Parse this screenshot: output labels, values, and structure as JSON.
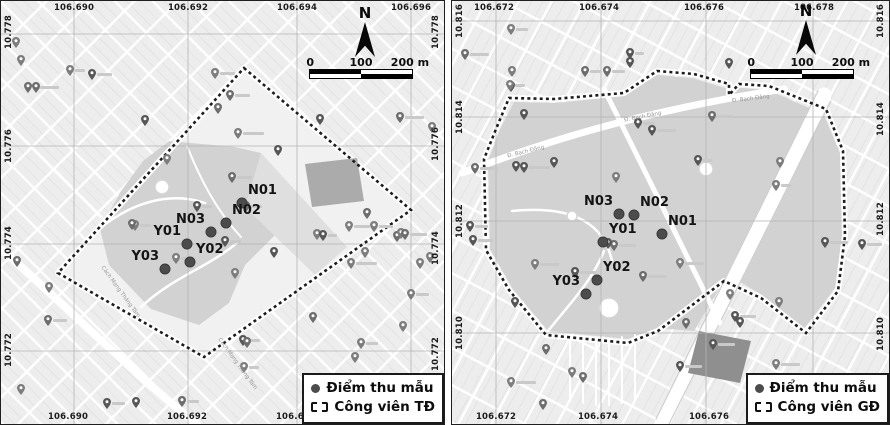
{
  "colors": {
    "map_bg": "#ededed",
    "street": "#ffffff",
    "grid_line": "#b3b3b3",
    "diamond_interior": "#f1f1f1",
    "park_fill": "#d2d2d2",
    "park_fill_light": "#dfdfdf",
    "boundary": "#1d1d1d",
    "point_dot": "#4c4c4c",
    "pin": "#6d6d6d",
    "text": "#141414"
  },
  "panels": [
    {
      "id": "tao-dan",
      "size": {
        "w": 443,
        "h": 423
      },
      "north_label": "N",
      "scale_ticks": [
        "0",
        "100",
        "200 m"
      ],
      "north_pos": {
        "left": 344,
        "top": 5
      },
      "scale_pos": {
        "left": 308,
        "top": 55
      },
      "coords": {
        "top": [
          {
            "t": "106.690",
            "x": 73
          },
          {
            "t": "106.692",
            "x": 187
          },
          {
            "t": "106.694",
            "x": 296
          },
          {
            "t": "106.696",
            "x": 410
          }
        ],
        "bottom": [
          {
            "t": "106.690",
            "x": 67
          },
          {
            "t": "106.692",
            "x": 186
          },
          {
            "t": "106.694",
            "x": 295
          }
        ],
        "left": [
          {
            "t": "10.778",
            "y": 31
          },
          {
            "t": "10.776",
            "y": 145
          },
          {
            "t": "10.774",
            "y": 242
          },
          {
            "t": "10.772",
            "y": 349
          }
        ],
        "right": [
          {
            "t": "10.778",
            "y": 31
          },
          {
            "t": "10.776",
            "y": 143
          },
          {
            "t": "10.774",
            "y": 247
          },
          {
            "t": "10.772",
            "y": 353
          }
        ]
      },
      "grid": {
        "v": [
          73,
          187,
          296,
          410
        ],
        "h": [
          33,
          145,
          243,
          350
        ]
      },
      "boundary": [
        [
          243,
          67
        ],
        [
          410,
          209
        ],
        [
          203,
          356
        ],
        [
          57,
          272
        ]
      ],
      "interior": [
        [
          243,
          67
        ],
        [
          410,
          209
        ],
        [
          203,
          356
        ],
        [
          57,
          272
        ]
      ],
      "park_fills": [
        {
          "c": "#d2d2d2",
          "pts": [
            [
              168,
              140
            ],
            [
              234,
              146
            ],
            [
              260,
              152
            ],
            [
              264,
              172
            ],
            [
              302,
              206
            ],
            [
              268,
              240
            ],
            [
              244,
              264
            ],
            [
              228,
              302
            ],
            [
              198,
              324
            ],
            [
              150,
              308
            ],
            [
              108,
              264
            ],
            [
              99,
              228
            ],
            [
              120,
              190
            ],
            [
              142,
              160
            ]
          ]
        },
        {
          "c": "#dfdfdf",
          "pts": [
            [
              260,
              152
            ],
            [
              346,
              246
            ],
            [
              314,
              274
            ],
            [
              244,
              206
            ]
          ]
        }
      ],
      "dark_blocks": [
        {
          "c": "#ababab",
          "pts": [
            [
              304,
              163
            ],
            [
              356,
              157
            ],
            [
              363,
              200
            ],
            [
              311,
              206
            ]
          ]
        }
      ],
      "roads": [
        {
          "d": "M0,248 C60,300 140,380 196,423",
          "w": 8
        },
        {
          "d": "M98,228 C130,202 168,190 204,202",
          "w": 2.5
        },
        {
          "d": "M140,306 C172,276 204,268 236,242",
          "w": 2.5
        },
        {
          "d": "M186,145 C200,180 216,210 240,236",
          "w": 2
        }
      ],
      "circles": [
        {
          "x": 161,
          "y": 186,
          "r": 7
        }
      ],
      "points": [
        {
          "label": "N01",
          "x": 241,
          "y": 202,
          "side": "right"
        },
        {
          "label": "N02",
          "x": 225,
          "y": 222,
          "side": "right"
        },
        {
          "label": "N03",
          "x": 210,
          "y": 231,
          "side": "left"
        },
        {
          "label": "Y01",
          "x": 186,
          "y": 243,
          "side": "left"
        },
        {
          "label": "Y02",
          "x": 189,
          "y": 261,
          "side": "right"
        },
        {
          "label": "Y03",
          "x": 164,
          "y": 268,
          "side": "left"
        }
      ],
      "street_labels": [
        {
          "t": "Cách Mạng Tháng Tám",
          "x": 88,
          "y": 288,
          "a": 54
        },
        {
          "t": "Cách Mạng Tháng Tám",
          "x": 205,
          "y": 360,
          "a": 54
        }
      ],
      "legend": {
        "points": "Điểm thu mẫu",
        "park": "Công viên TĐ"
      },
      "pin_seed": 7
    },
    {
      "id": "gia-dinh",
      "size": {
        "w": 437,
        "h": 423
      },
      "north_label": "N",
      "scale_ticks": [
        "0",
        "100",
        "200 m"
      ],
      "north_pos": {
        "left": 334,
        "top": 3
      },
      "scale_pos": {
        "left": 298,
        "top": 55
      },
      "coords": {
        "top": [
          {
            "t": "106.672",
            "x": 42
          },
          {
            "t": "106.674",
            "x": 147
          },
          {
            "t": "106.676",
            "x": 252
          },
          {
            "t": "106.678",
            "x": 362
          }
        ],
        "bottom": [
          {
            "t": "106.672",
            "x": 44
          },
          {
            "t": "106.674",
            "x": 146
          },
          {
            "t": "106.676",
            "x": 257
          }
        ],
        "left": [
          {
            "t": "10.816",
            "y": 20
          },
          {
            "t": "10.814",
            "y": 116
          },
          {
            "t": "10.812",
            "y": 220
          },
          {
            "t": "10.810",
            "y": 332
          }
        ],
        "right": [
          {
            "t": "10.816",
            "y": 20
          },
          {
            "t": "10.814",
            "y": 118
          },
          {
            "t": "10.812",
            "y": 218
          },
          {
            "t": "10.810",
            "y": 333
          }
        ]
      },
      "grid": {
        "v": [
          44,
          149,
          254,
          361
        ],
        "h": [
          20,
          116,
          220,
          332
        ]
      },
      "boundary": [
        [
          205,
          70
        ],
        [
          242,
          73
        ],
        [
          277,
          83
        ],
        [
          277,
          94
        ],
        [
          287,
          83
        ],
        [
          317,
          85
        ],
        [
          374,
          108
        ],
        [
          391,
          150
        ],
        [
          393,
          235
        ],
        [
          386,
          290
        ],
        [
          354,
          332
        ],
        [
          309,
          297
        ],
        [
          272,
          280
        ],
        [
          206,
          330
        ],
        [
          176,
          342
        ],
        [
          94,
          334
        ],
        [
          57,
          289
        ],
        [
          34,
          249
        ],
        [
          32,
          158
        ],
        [
          44,
          128
        ],
        [
          57,
          97
        ],
        [
          102,
          98
        ],
        [
          172,
          92
        ]
      ],
      "interior": null,
      "park_fills": [
        {
          "c": "#d2d2d2",
          "pts": [
            [
              205,
              74
            ],
            [
              240,
              77
            ],
            [
              276,
              88
            ],
            [
              290,
              87
            ],
            [
              316,
              89
            ],
            [
              364,
              110
            ],
            [
              334,
              158
            ],
            [
              298,
              232
            ],
            [
              260,
              300
            ],
            [
              242,
              330
            ],
            [
              205,
              327
            ],
            [
              176,
              338
            ],
            [
              96,
              330
            ],
            [
              60,
              287
            ],
            [
              38,
              248
            ],
            [
              36,
              160
            ],
            [
              48,
              128
            ],
            [
              62,
              101
            ],
            [
              104,
              102
            ],
            [
              172,
              95
            ]
          ]
        },
        {
          "c": "#d2d2d2",
          "pts": [
            [
              372,
              114
            ],
            [
              388,
              152
            ],
            [
              390,
              234
            ],
            [
              383,
              287
            ],
            [
              352,
              328
            ],
            [
              310,
              294
            ],
            [
              280,
              276
            ],
            [
              330,
              180
            ],
            [
              353,
              138
            ]
          ]
        }
      ],
      "dark_blocks": [
        {
          "c": "#8f8f8f",
          "pts": [
            [
              247,
              330
            ],
            [
              299,
              340
            ],
            [
              288,
              382
            ],
            [
              236,
              372
            ]
          ]
        }
      ],
      "roads": [
        {
          "d": "M372,94 L210,423",
          "w": 15
        },
        {
          "d": "M379,100 L217,423",
          "w": 1.2,
          "c": "#cfcfcf"
        },
        {
          "d": "M366,90 L204,418",
          "w": 1.2,
          "c": "#cfcfcf"
        },
        {
          "d": "M10,172 C90,142 180,112 332,88",
          "w": 7
        },
        {
          "d": "M152,88 L268,322",
          "w": 5
        },
        {
          "d": "M60,210 C110,205 150,215 160,260",
          "w": 2.5
        },
        {
          "d": "M96,330 C120,300 140,280 152,250",
          "w": 2.5
        },
        {
          "d": "M118,334 L118,400",
          "w": 2
        },
        {
          "d": "M131,336 L131,402",
          "w": 2
        },
        {
          "d": "M144,338 L144,404",
          "w": 2
        },
        {
          "d": "M157,338 L157,404",
          "w": 2
        },
        {
          "d": "M170,336 L170,402",
          "w": 2
        },
        {
          "d": "M183,334 L183,398",
          "w": 2
        }
      ],
      "circles": [
        {
          "x": 157,
          "y": 307,
          "r": 10
        },
        {
          "x": 254,
          "y": 168,
          "r": 7
        },
        {
          "x": 120,
          "y": 215,
          "r": 5
        }
      ],
      "points": [
        {
          "label": "N03",
          "x": 167,
          "y": 213,
          "side": "left"
        },
        {
          "label": "N02",
          "x": 182,
          "y": 214,
          "side": "right"
        },
        {
          "label": "N01",
          "x": 210,
          "y": 233,
          "side": "right"
        },
        {
          "label": "Y01",
          "x": 151,
          "y": 241,
          "side": "right"
        },
        {
          "label": "Y02",
          "x": 145,
          "y": 279,
          "side": "right"
        },
        {
          "label": "Y03",
          "x": 134,
          "y": 293,
          "side": "left"
        }
      ],
      "street_labels": [
        {
          "t": "Đ. Bạch Đằng",
          "x": 55,
          "y": 148,
          "a": -14
        },
        {
          "t": "Đ. Bạch Đằng",
          "x": 172,
          "y": 113,
          "a": -11
        },
        {
          "t": "Đ. Bạch Đằng",
          "x": 280,
          "y": 95,
          "a": -7
        }
      ],
      "legend": {
        "points": "Điểm thu mẫu",
        "park": "Công viên GĐ"
      },
      "pin_seed": 13
    }
  ]
}
